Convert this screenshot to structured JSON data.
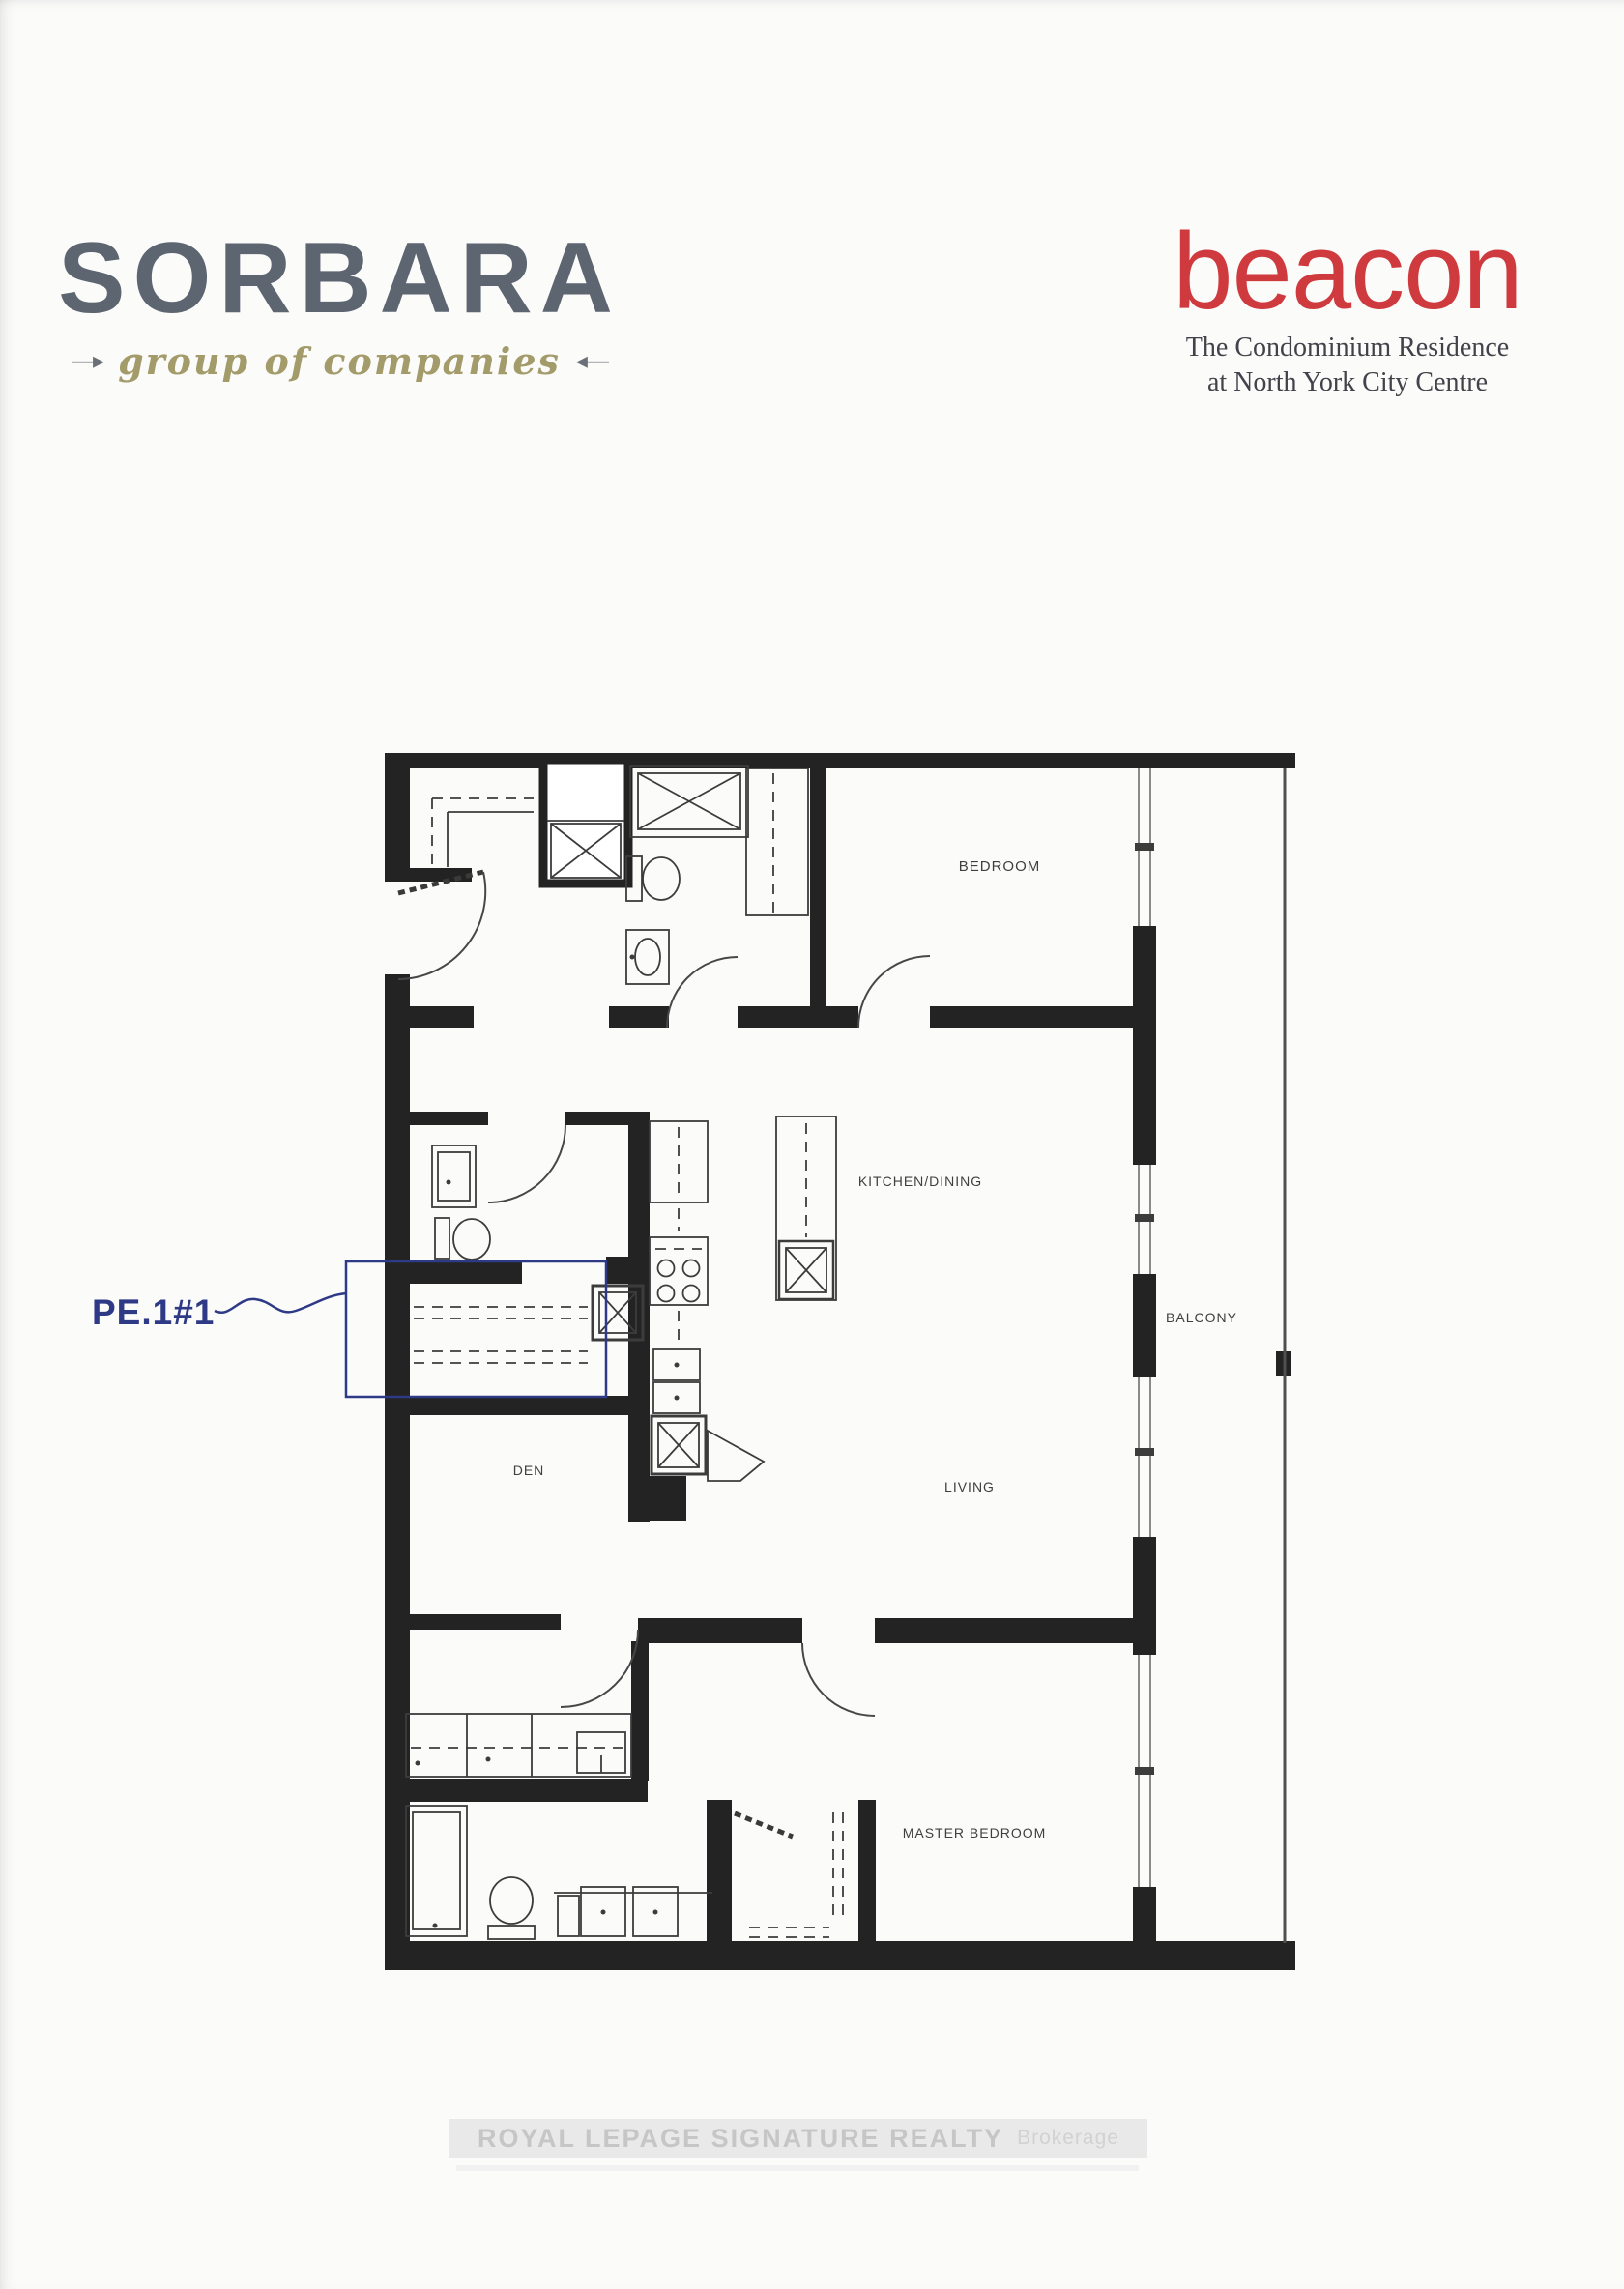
{
  "header": {
    "sorbara": {
      "title": "SORBARA",
      "tagline": "group of companies",
      "arrow_left": "—▸",
      "arrow_right": "◂—"
    },
    "beacon": {
      "title": "beacon",
      "subtitle_line1": "The Condominium Residence",
      "subtitle_line2": "at North York City Centre"
    }
  },
  "floorplan": {
    "unit_label": "PE.1#1",
    "rooms": {
      "bedroom": "BEDROOM",
      "kitchen_dining": "KITCHEN/DINING",
      "living": "LIVING",
      "balcony": "BALCONY",
      "den": "DEN",
      "master_bedroom": "MASTER BEDROOM"
    }
  },
  "footer": {
    "watermark_main": "ROYAL LEPAGE SIGNATURE REALTY",
    "watermark_suffix": "Brokerage"
  },
  "colors": {
    "page": "#fbfbfa",
    "wall": "#232323",
    "callout": "#2e3a86",
    "beacon-red": "#cf3a3f",
    "sorbara-gray": "#5d6571",
    "tagline-olive": "#a39b6a",
    "label": "#3f3f3f",
    "watermark-text": "#c6c6c6",
    "watermark-band": "#e9e9e9"
  }
}
